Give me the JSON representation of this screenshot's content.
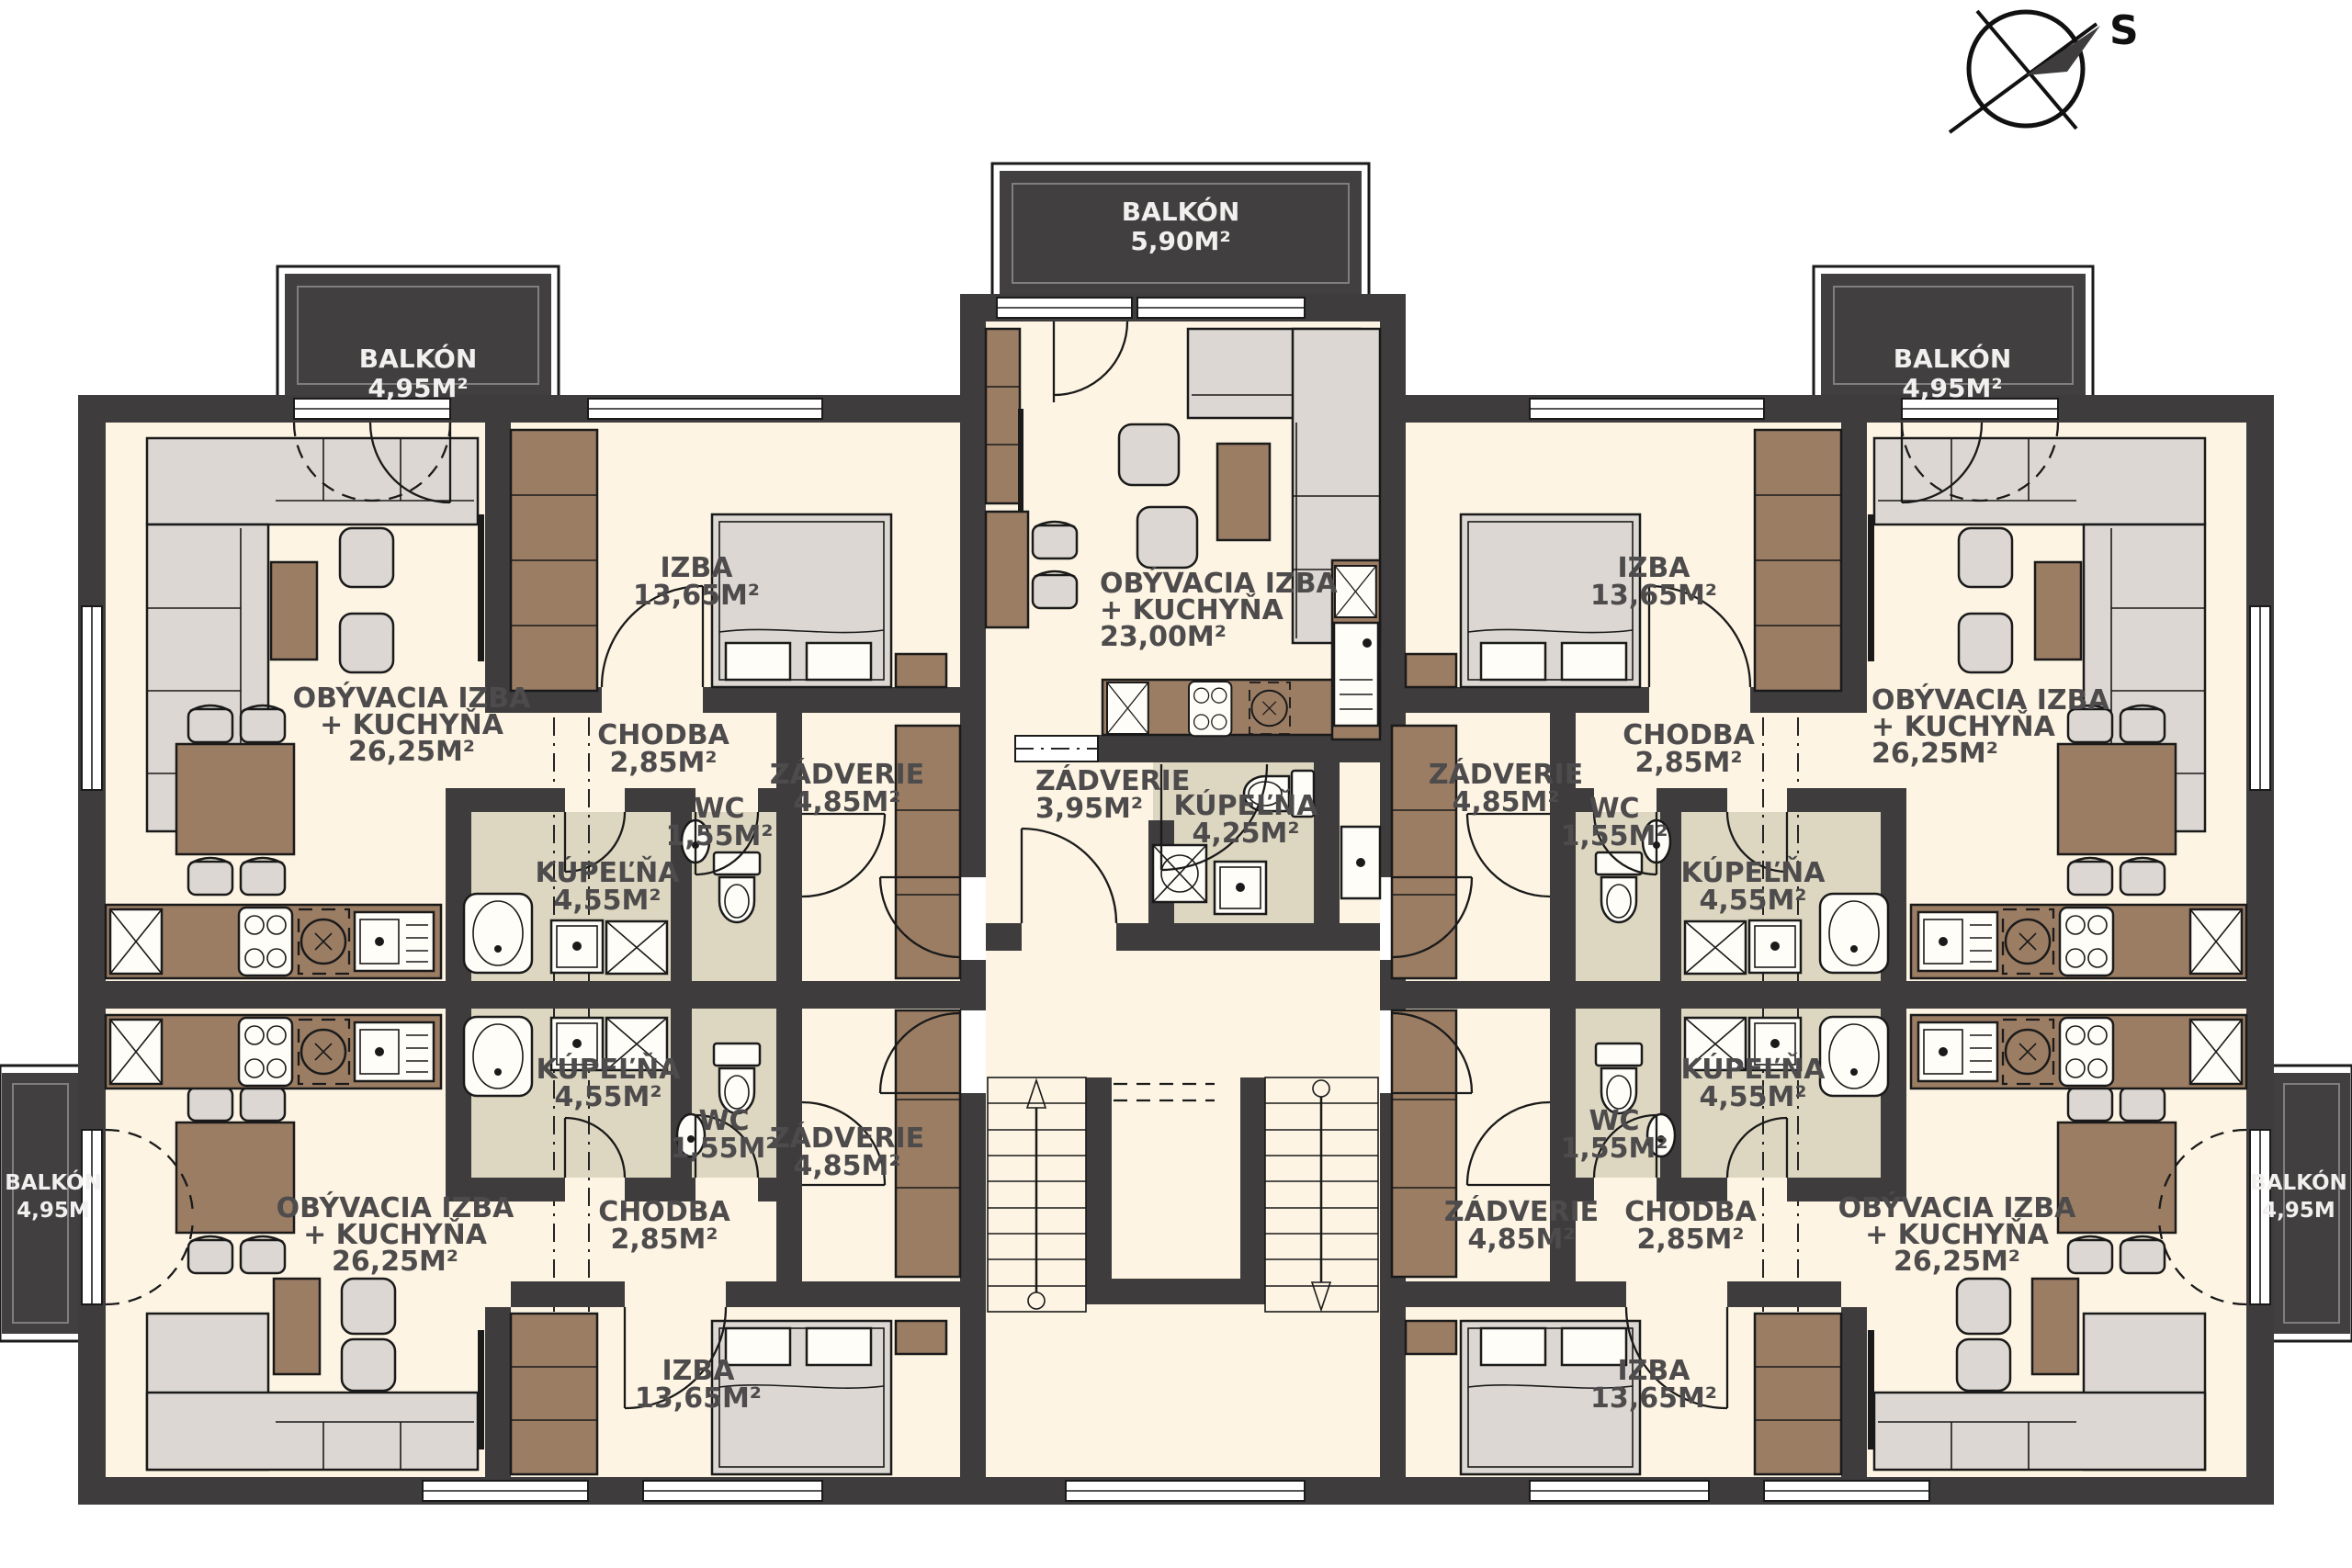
{
  "colors": {
    "wall": "#3e3c3d",
    "floor": "#fdf4e3",
    "bathroom_floor": "#ddd7c1",
    "wood_furniture": "#9b7d64",
    "soft_furniture": "#dcd7d2",
    "balcony_fill": "#413f40",
    "label_text": "#4d4b4c",
    "balcony_label_text": "#f2f0ee"
  },
  "compass": {
    "north_label": "S"
  },
  "balconies": {
    "top_left": {
      "title": "BALKÓN",
      "area": "4,95M²"
    },
    "top_center": {
      "title": "BALKÓN",
      "area": "5,90M²"
    },
    "top_right": {
      "title": "BALKÓN",
      "area": "4,95M²"
    },
    "left": {
      "title": "BALKÓN",
      "area": "4,95M"
    },
    "right": {
      "title": "BALKÓN",
      "area": "4,95M"
    }
  },
  "apartments": {
    "top_left": {
      "living_room": {
        "line1": "OBÝVACIA IZBA",
        "line2": "+ KUCHYŇA",
        "area": "26,25M²"
      },
      "bedroom": {
        "name": "IZBA",
        "area": "13,65M²"
      },
      "hallway": {
        "name": "CHODBA",
        "area": "2,85M²"
      },
      "vestibule": {
        "name": "ZÁDVERIE",
        "area": "4,85M²"
      },
      "toilet": {
        "name": "WC",
        "area": "1,55M²"
      },
      "bathroom": {
        "name": "KÚPEĽŇA",
        "area": "4,55M²"
      }
    },
    "top_center": {
      "living_room": {
        "line1": "OBÝVACIA IZBA",
        "line2": "+ KUCHYŇA",
        "area": "23,00M²"
      },
      "vestibule": {
        "name": "ZÁDVERIE",
        "area": "3,95M²"
      },
      "bathroom": {
        "name": "KÚPEĽŇA",
        "area": "4,25M²"
      }
    },
    "top_right": {
      "living_room": {
        "line1": "OBÝVACIA IZBA",
        "line2": "+ KUCHYŇA",
        "area": "26,25M²"
      },
      "bedroom": {
        "name": "IZBA",
        "area": "13,65M²"
      },
      "hallway": {
        "name": "CHODBA",
        "area": "2,85M²"
      },
      "vestibule": {
        "name": "ZÁDVERIE",
        "area": "4,85M²"
      },
      "toilet": {
        "name": "WC",
        "area": "1,55M²"
      },
      "bathroom": {
        "name": "KÚPEĽŇA",
        "area": "4,55M²"
      }
    },
    "bottom_left": {
      "living_room": {
        "line1": "OBÝVACIA IZBA",
        "line2": "+ KUCHYŇA",
        "area": "26,25M²"
      },
      "bedroom": {
        "name": "IZBA",
        "area": "13,65M²"
      },
      "hallway": {
        "name": "CHODBA",
        "area": "2,85M²"
      },
      "vestibule": {
        "name": "ZÁDVERIE",
        "area": "4,85M²"
      },
      "toilet": {
        "name": "WC",
        "area": "1,55M²"
      },
      "bathroom": {
        "name": "KÚPEĽŇA",
        "area": "4,55M²"
      }
    },
    "bottom_right": {
      "living_room": {
        "line1": "OBÝVACIA IZBA",
        "line2": "+ KUCHYŇA",
        "area": "26,25M²"
      },
      "bedroom": {
        "name": "IZBA",
        "area": "13,65M²"
      },
      "hallway": {
        "name": "CHODBA",
        "area": "2,85M²"
      },
      "vestibule": {
        "name": "ZÁDVERIE",
        "area": "4,85M²"
      },
      "toilet": {
        "name": "WC",
        "area": "1,55M²"
      },
      "bathroom": {
        "name": "KÚPEĽŇA",
        "area": "4,55M²"
      }
    }
  }
}
